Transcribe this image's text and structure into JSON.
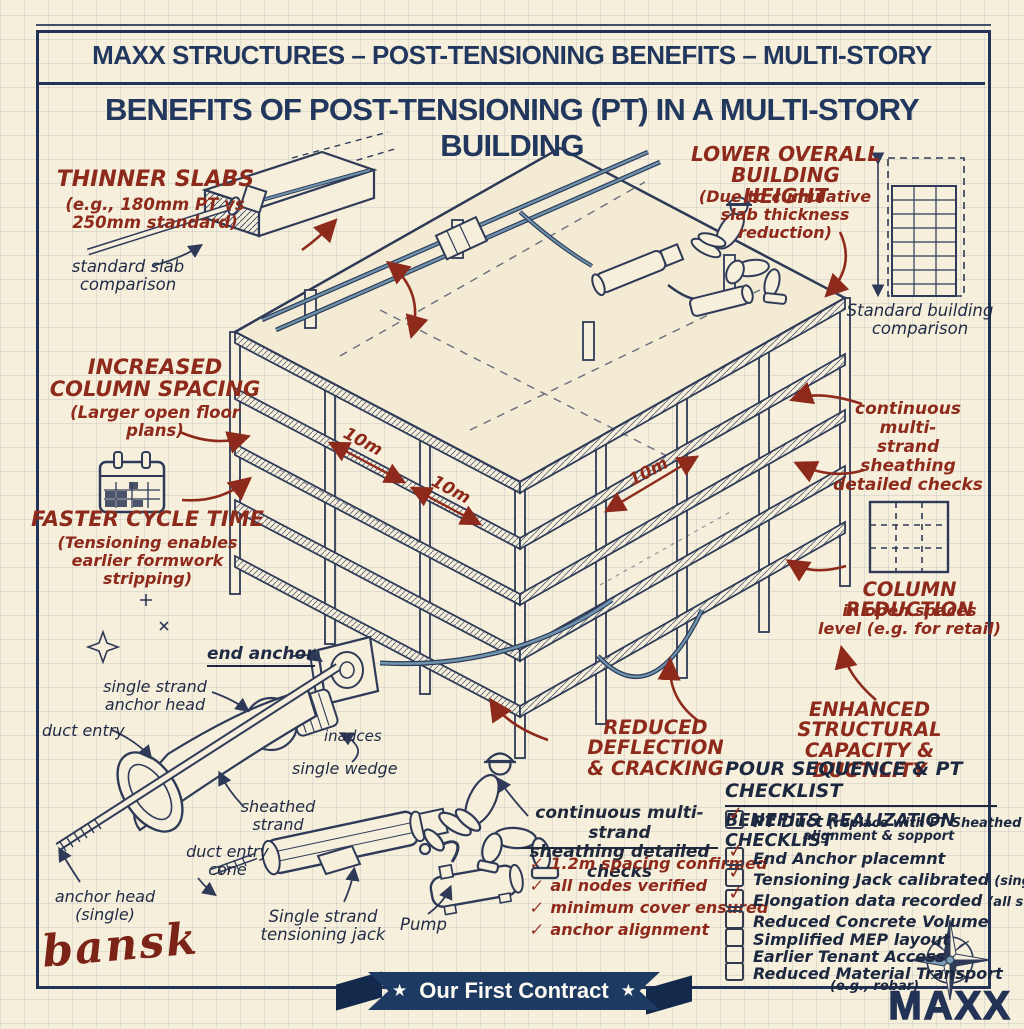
{
  "colors": {
    "paper": "#f6efdb",
    "ink": "#2e3a57",
    "navy_text": "#22375d",
    "red": "#8e2a1c",
    "steel_blue": "#6e93ac",
    "ribbon_navy": "#1d3a63"
  },
  "header": {
    "banner": "MAXX STRUCTURES – POST-TENSIONING BENEFITS – MULTI-STORY",
    "title": "BENEFITS OF POST-TENSIONING (PT) IN A MULTI-STORY BUILDING"
  },
  "callouts": {
    "thinner_slabs": {
      "title": "THINNER SLABS",
      "detail": "(e.g., 180mm PT vs\n250mm standard)"
    },
    "standard_slab_note": "standard slab\ncomparison",
    "increased_column_spacing": {
      "title": "INCREASED\nCOLUMN SPACING",
      "detail": "(Larger open floor plans)"
    },
    "faster_cycle_time": {
      "title": "FASTER CYCLE TIME",
      "detail": "(Tensioning enables\nearlier formwork stripping)"
    },
    "lower_building_height": {
      "title": "LOWER OVERALL\nBUILDING HEIGHT",
      "detail": "(Due to cumulative\nslab thickness reduction)"
    },
    "standard_building_note": "Standard building\ncomparison",
    "sheathing_checks_note": "continuous multi-\nstrand sheathing\ndetailed checks",
    "column_reduction": {
      "title": "COLUMN REDUCTION",
      "detail": "in open spaces\nlevel (e.g. for retail)"
    },
    "reduced_deflection": {
      "title": "REDUCED DEFLECTION\n& CRACKING"
    },
    "enhanced_capacity": {
      "title": "ENHANCED STRUCTURAL\nCAPACITY & DUCTILITY"
    }
  },
  "dimension_labels": [
    "10m",
    "10m",
    "10m"
  ],
  "part_labels": {
    "end_anchor": "end anchor",
    "single_strand_anchor_head": "single strand\nanchor head",
    "duct_entry": "duct entry",
    "wedges": "inadces",
    "single_wedge": "single wedge",
    "sheathed_strand": "sheathed\nstrand",
    "duct_entry_cone": "duct entry\ncone",
    "anchor_head_single": "anchor head\n(single)",
    "tensioning_jack": "Single strand\ntensioning jack",
    "pump": "Pump"
  },
  "field_checks": {
    "heading": "continuous multi-strand\nsheathing detailed checks",
    "marker": "✓",
    "items": [
      "1.2m spacing confirmed",
      "all nodes verified",
      "minimum cover ensured",
      "anchor alignment"
    ]
  },
  "checklist": {
    "heading": "POUR SEQUENCE & PT CHECKLIST",
    "subheading": "BENEFITS REALIZATION CHECKLIST",
    "check_glyph": "✓",
    "items": [
      {
        "label": "PT Duct",
        "note": "(replace with FT Sheathed Strand)",
        "extra": "alignment & sopport",
        "checked": true
      },
      {
        "label": "End Anchor placemnt",
        "note": "",
        "extra": "",
        "checked": true
      },
      {
        "label": "Tensioning Jack calibrated",
        "note": "(single strand)",
        "extra": "",
        "checked": true
      },
      {
        "label": "Elongation data recorded",
        "note": "(all strands)",
        "extra": "",
        "checked": true
      },
      {
        "label": "Reduced Concrete Volume",
        "note": "",
        "extra": "",
        "checked": false
      },
      {
        "label": "Simplified MEP layout",
        "note": "",
        "extra": "",
        "checked": false
      },
      {
        "label": "Earlier Tenant Access",
        "note": "",
        "extra": "",
        "checked": false
      },
      {
        "label": "Reduced Material Transport",
        "note": "(e.g., rebar)",
        "extra": "",
        "checked": false
      }
    ]
  },
  "footer": {
    "ribbon_label": "Our First Contract",
    "ribbon_star": "★",
    "signature": "bansk",
    "logo": "MAXX"
  },
  "icons": {
    "calendar": "calendar-icon",
    "floor_plan": "floor-plan-grid-icon",
    "building_comparison": "building-comparison-icon",
    "compass": "compass-rose-icon",
    "sparkle": "sparkle-icon"
  }
}
